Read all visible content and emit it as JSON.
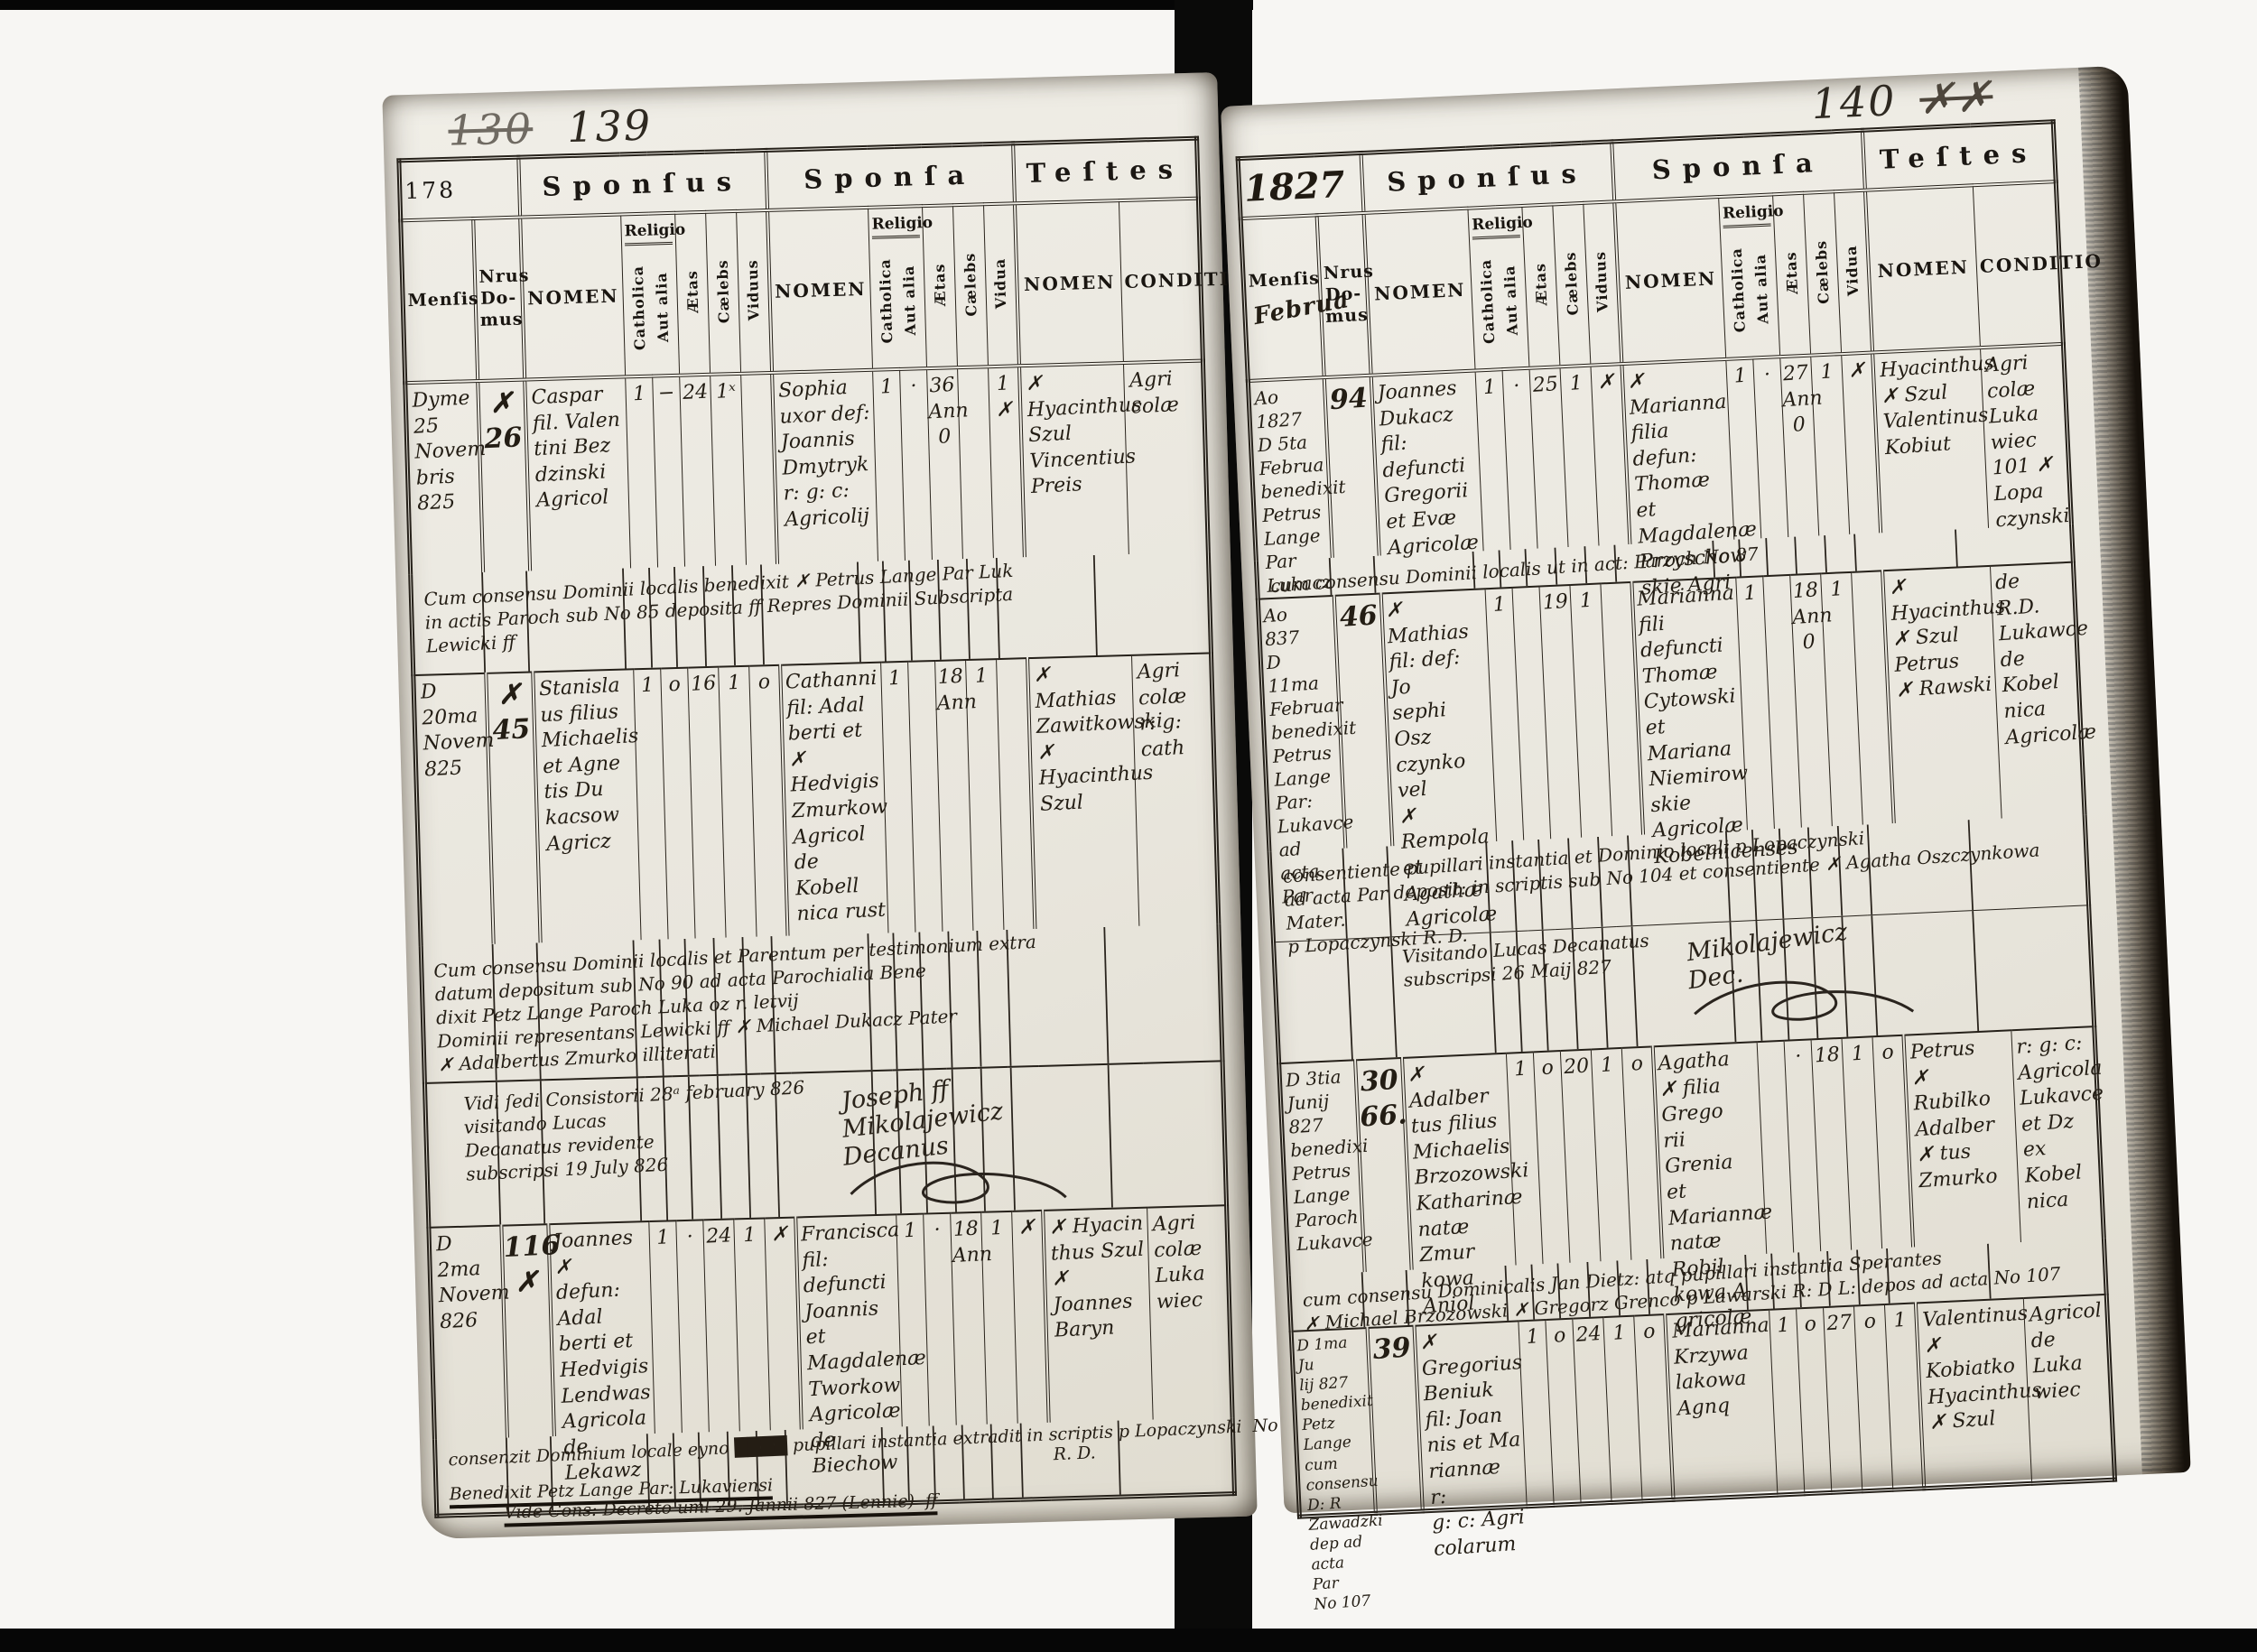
{
  "headers": {
    "sponsus": "Sponſus",
    "sponsa": "Sponſa",
    "testes": "Teſtes",
    "mensis": "Menſis",
    "nrus_domus": "Nrus\nDo-\nmus",
    "nomen": "NOMEN",
    "religio": "Religio",
    "catholica": "Catholica",
    "aut_alia": "Aut alia",
    "aetas": "Ætas",
    "caelebs": "Cælebs",
    "viduus": "Viduus",
    "vidua": "Vidua",
    "conditio": "CONDITIO"
  },
  "left_page": {
    "corner_crossed_number": "130",
    "corner_number": "139",
    "form_number": "178",
    "entries": [
      {
        "mensis": "Dyme\n25\nNovem\nbris\n825",
        "nrus": "✗\n26",
        "sponsus_nomen": "Caspar\nfil. Valen\ntini Bez\ndzinski\nAgricol",
        "sponsus_catholica": "1",
        "sponsus_aut_alia": "−",
        "sponsus_aetas": "24",
        "sponsus_caelebs": "1ˣ",
        "sponsus_viduus": "",
        "sponsa_nomen": "Sophia\nuxor def:\nJoannis\nDmytryk\nr: g: c:\nAgricolij",
        "sponsa_catholica": "1",
        "sponsa_aut_alia": "·",
        "sponsa_aetas": "36\nAnn\n0",
        "sponsa_caelebs": "",
        "sponsa_vidua": "1\n✗",
        "testes_nomen": "✗ Hyacinthus\nSzul\nVincentius\nPreis",
        "conditio": "Agri\ncolæ",
        "note": "Cum consensu Dominii localis benedixit ✗ Petrus Lange Par Luk\nin actis Paroch sub No 85 deposita ff Repres Dominii Subscripta\nLewicki ff"
      },
      {
        "mensis": "D 20ma\nNovem\n825",
        "nrus": "✗\n45",
        "sponsus_nomen": "Stanisla\nus filius\nMichaelis\net Agne\ntis Du\nkacsow\nAgricz",
        "sponsus_catholica": "1",
        "sponsus_aut_alia": "o",
        "sponsus_aetas": "16",
        "sponsus_caelebs": "1",
        "sponsus_viduus": "o",
        "sponsa_nomen": "Cathanni\nfil: Adal\nberti et\n✗ Hedvigis\nZmurkow\nAgricol\nde Kobell\nnica rust",
        "sponsa_catholica": "1",
        "sponsa_aut_alia": "",
        "sponsa_aetas": "18\nAnn",
        "sponsa_caelebs": "1",
        "sponsa_vidua": "",
        "testes_nomen": "✗ Mathias\nZawitkowski\n✗ Hyacinthus\nSzul",
        "conditio": "Agri\ncolæ\nr: g:\ncath",
        "note": "Cum consensu Dominii localis et Parentum per testimonium extra\ndatum depositum sub No 90 ad acta Parochialia Bene\ndixit Petz Lange Paroch Luka oz r. letvij\nDominii representans Lewicki ff        ✗ Michael Dukacz Pater\n✗ Adalbertus Zmurko illiterati"
      },
      {
        "mensis": "D 2ma\nNovem\n826",
        "nrus": "116\n✗",
        "sponsus_nomen": "Joannes ✗\ndefun: Adal\nberti et\nHedvigis\nLendwas\nAgricola\nde Lekawz",
        "sponsus_catholica": "1",
        "sponsus_aut_alia": "·",
        "sponsus_aetas": "24",
        "sponsus_caelebs": "1",
        "sponsus_viduus": "✗",
        "sponsa_nomen": "Francisca\nfil: defuncti\nJoannis\net Magdalenæ\nTworkow\nAgricolæ\nde Biechow",
        "sponsa_catholica": "1",
        "sponsa_aut_alia": "·",
        "sponsa_aetas": "18\nAnn",
        "sponsa_caelebs": "1",
        "sponsa_vidua": "✗",
        "testes_nomen": "✗ Hyacin\nthus Szul\n✗ Joannes\nBaryn",
        "conditio": "Agri\ncolæ\nLuka\nwiec"
      }
    ],
    "visitation": {
      "top_line": "Vidi ſedi Consistorii 28ᵃ february 826",
      "sig_top": "Joseph ff",
      "lines": "visitando Lucas\nDecanatus revidente\nsubscripsi 19 July 826",
      "sig_name": "Mikolajewicz",
      "sig_title": "Decanus"
    },
    "bottom_note": {
      "l1": "consenzit Dominium locale eyno ████ pupillari instantia extradit in scriptis p Lopaczynski  No 98",
      "l2": "R. D.",
      "l3": "Benedixit Petz Lange Par: Lukaviensi",
      "l4": "Vide Cons: Decreto uml 29. Jannii 827 (Lennie)  ff"
    }
  },
  "right_page": {
    "corner_number": "140",
    "corner_scribble": "✗✗",
    "year_label": "1827",
    "mensis_annotation": "Februa",
    "entries": [
      {
        "mensis": "Ao 1827\nD 5ta\nFebrua\nbenedixit\nPetrus Lange\nPar Lukacz",
        "nrus": "94",
        "sponsus_nomen": "Joannes\nDukacz\nfil: defuncti\nGregorii\net Evæ\nAgricolæ",
        "sponsus_catholica": "1",
        "sponsus_aut_alia": "·",
        "sponsus_aetas": "25",
        "sponsus_caelebs": "1",
        "sponsus_viduus": "✗",
        "sponsa_nomen": "✗ Marianna\nfilia defun:\nThomæ et\nMagdalenæ\nPrzyschow\nskie Agri",
        "sponsa_catholica": "1",
        "sponsa_aut_alia": "·",
        "sponsa_aetas": "27\nAnn\n0",
        "sponsa_caelebs": "1",
        "sponsa_vidua": "✗",
        "testes_nomen": "Hyacinthus\n✗ Szul\nValentinus\nKobiut",
        "conditio": "Agri\ncolæ\nLuka\nwiec\n101 ✗ Lopa\nczynski",
        "note": "cum consensu Dominii localis ut in act: Paroch  No 87"
      },
      {
        "mensis": "Ao 837\nD 11ma\nFebruar\nbenedixit\nPetrus\nLange\nPar: Lukavce\nad acta Par",
        "nrus": "46",
        "sponsus_nomen": "✗ Mathias\nfil: def: Jo\nsephi Osz\nczynko vel\n✗ Rempola\net Agathæ\nAgricolæ",
        "sponsus_catholica": "1",
        "sponsus_aut_alia": "",
        "sponsus_aetas": "19",
        "sponsus_caelebs": "1",
        "sponsus_viduus": "",
        "sponsa_nomen": "Marianna\nfili defuncti\nThomæ\nCytowski\net Mariana\nNiemirow\nskie\nAgricolæ\nKobelnicenses",
        "sponsa_catholica": "1",
        "sponsa_aut_alia": "",
        "sponsa_aetas": "18\nAnn\n0",
        "sponsa_caelebs": "1",
        "sponsa_vidua": "",
        "testes_nomen": "✗ Hyacinthus\n✗ Szul\nPetrus\n✗ Rawski",
        "conditio": "de R.D.\nLukawce\nde Kobel\nnica\nAgricolæ",
        "note": "consentiente pupillari instantia et Dominio locali p Lopaczynski\nad acta Par deposit: in scriptis sub No 104 et consentiente ✗ Agatha Oszczynkowa Mater.\np Lopaczynski R. D."
      },
      {
        "mensis": "D 3tia\nJunij\n827\nbenedixi\nPetrus Lange\nParoch Lukavce",
        "nrus": "30\n66.",
        "sponsus_nomen": "✗ Adalber\ntus filius\nMichaelis\nBrzozowski\nKatharinæ\nnatæ Zmur\nkowa Aniol",
        "sponsus_catholica": "1",
        "sponsus_aut_alia": "o",
        "sponsus_aetas": "20",
        "sponsus_caelebs": "1",
        "sponsus_viduus": "o",
        "sponsa_nomen": "Agatha\n✗ filia Grego\nrii Grenia\net Mariannæ\nnatæ Robil\nkowa A\ngricolæ",
        "sponsa_catholica": "",
        "sponsa_aut_alia": "·",
        "sponsa_aetas": "18",
        "sponsa_caelebs": "1",
        "sponsa_vidua": "o",
        "testes_nomen": "Petrus\n✗ Rubilko\nAdalber\n✗ tus\nZmurko",
        "conditio": "r: g: c:\nAgricola\nLukavce\net Dz\nex Kobel\nnica",
        "note": "cum consensu Dominicalis Jan Dietz: atq pupillari instantia Sperantes\n✗ Michael Brzozowski    ✗ Gregorz Grenco    p Lawarski R: D L: depos ad acta No 107"
      },
      {
        "mensis": "D 1ma Ju\nlij 827\nbenedixit\nPetz Lange\ncum consensu\nD: R Zawadzki\ndep ad acta Par\nNo 107",
        "nrus": "39",
        "sponsus_nomen": "✗ Gregorius\nBeniuk\nfil: Joan\nnis et Ma\nriannæ r:\ng: c: Agri\ncolarum",
        "sponsus_catholica": "1",
        "sponsus_aut_alia": "o",
        "sponsus_aetas": "24",
        "sponsus_caelebs": "1",
        "sponsus_viduus": "o",
        "sponsa_nomen": "Marianna\nKrzywa\nlakowa\nAgnq",
        "sponsa_catholica": "1",
        "sponsa_aut_alia": "o",
        "sponsa_aetas": "27",
        "sponsa_caelebs": "o",
        "sponsa_vidua": "1",
        "testes_nomen": "Valentinus\n✗ Kobiatko\nHyacinthus\n✗ Szul",
        "conditio": "Agricol\nde\nLuka\nwiec"
      }
    ],
    "visitation": {
      "lines": "Visitando Lucas Decanatus\nsubscripsi 26 Maij 827",
      "sig_name": "Mikolajewicz",
      "sig_title": "Dec."
    }
  }
}
